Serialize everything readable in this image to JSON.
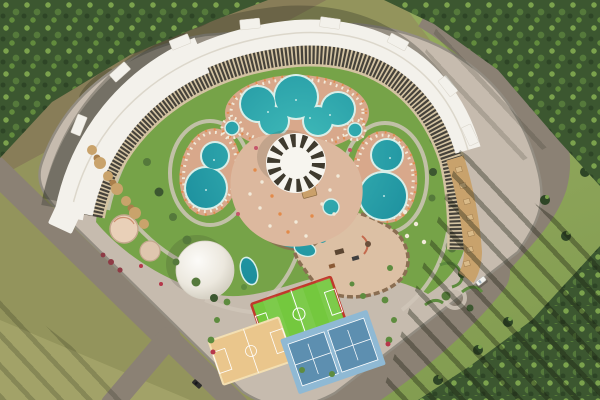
{
  "meta": {
    "type": "aerial-architectural-render",
    "subject": "Top-down aerial 3D rendering of a crescent-shaped resort hotel complex with water park, pools and sports courts, surrounded by pine forest and roads",
    "view": "top-down aerial",
    "width": 600,
    "height": 400
  },
  "palette": {
    "forest_dark": "#3c5730",
    "forest_mid": "#55793b",
    "forest_light": "#7ba24d",
    "pine_dark": "#2e4526",
    "grass_right": "#8ea55a",
    "field_olive": "#93945c",
    "field_light": "#a2a268",
    "road_olive": "#887d58",
    "road_gray": "#8b8174",
    "parcel_pave": "#c6bbae",
    "lawn": "#76a348",
    "lawn_dark": "#5e8c3f",
    "plaza": "#dcb89e",
    "deck": "#d8a88b",
    "pool_rim": "#d8efe9",
    "pool_mid": "#1f93a0",
    "pool_deep": "#14798a",
    "pool_light": "#41bcba",
    "roof": "#f3f1eb",
    "facade_dark": "#46423a",
    "facade_beige": "#d3c3a2",
    "canopy_white": "#f7f5ef",
    "canopy_stripe": "#3f3a2e",
    "dome": "#efece4",
    "dome_shade": "#cdc8ba",
    "court_green": "#74c83e",
    "court_red": "#c0392b",
    "court_tan": "#eac68c",
    "court_blue": "#8fb9d4",
    "court_blue_dark": "#5d8fb0",
    "cabana": "#c8a26c",
    "rock": "#8a6e52",
    "sand": "#dcc0a4",
    "umbrella_orange": "#e28a4a",
    "umbrella_white": "#f2ead9",
    "wall": "#938d82",
    "path": "#cfc6b8",
    "shadow": "rgba(40,42,32,0.30)",
    "car_white": "#f2f2ee",
    "car_dark": "#2e2d2b",
    "flower_red": "#b5374a",
    "flower_pink": "#c4566a",
    "pond": "#6fc6c8"
  },
  "scene": {
    "surroundings": {
      "forest_top_left": "deciduous and pine forest in upper-left corner",
      "forest_right": "dense pine forest along top-right edge",
      "forest_bottom_right": "pine forest in bottom-right corner casting long shadows toward upper-left",
      "field_bottom_left": "open olive-green field",
      "roads": [
        "olive-brown road between top-left forest and hotel",
        "gray road along lower-left boundary with Y junction",
        "wide gray road curving around the right and bottom-right of the resort"
      ],
      "gatehouse": "small white structure across the right road"
    },
    "vehicles": [
      {
        "name": "white-car",
        "location": "right road, mid-lower section"
      },
      {
        "name": "dark-car",
        "location": "lower-left road branch"
      }
    ],
    "building": {
      "description": "long crescent-shaped multi-story hotel with white roof, dark balcony facade facing the courtyard, roof bump-outs, terraced cabana units at the right wing end and rocky cabana cluster at the left wing"
    },
    "amenities": {
      "pools": [
        {
          "name": "lagoon-pool",
          "shape": "cloud-shaped freeform lagoon, top center"
        },
        {
          "name": "left-pool",
          "shape": "figure-eight pool, left side"
        },
        {
          "name": "right-pool",
          "shape": "figure-eight pool, right side"
        },
        {
          "name": "kids-pool-left",
          "shape": "small round pool"
        },
        {
          "name": "kids-pool-right",
          "shape": "small round pool"
        },
        {
          "name": "lazy-river",
          "shape": "winding rock-lined channel below plaza"
        },
        {
          "name": "dome-pond",
          "shape": "small pond beside event dome"
        }
      ],
      "central_canopy": "large circular white canopy with radial dark stripes over a beach-bar plaza with umbrellas",
      "event_dome": "large white membrane dome, lower-left of center",
      "kids_water_park": "rock-bordered sandy adventure/water-play area with slides",
      "courts": [
        {
          "name": "football-pitch",
          "surface": "green with red border"
        },
        {
          "name": "basketball-court",
          "surface": "tan wood-look"
        },
        {
          "name": "tennis-courts",
          "surface": "two blue hard courts side by side"
        }
      ],
      "playground": "circular paved play pads with small dark-red dome tents",
      "landscaping": "lawns, hedges, flowering shrubs, winding paths, lounger and umbrella rings around all pools"
    }
  }
}
